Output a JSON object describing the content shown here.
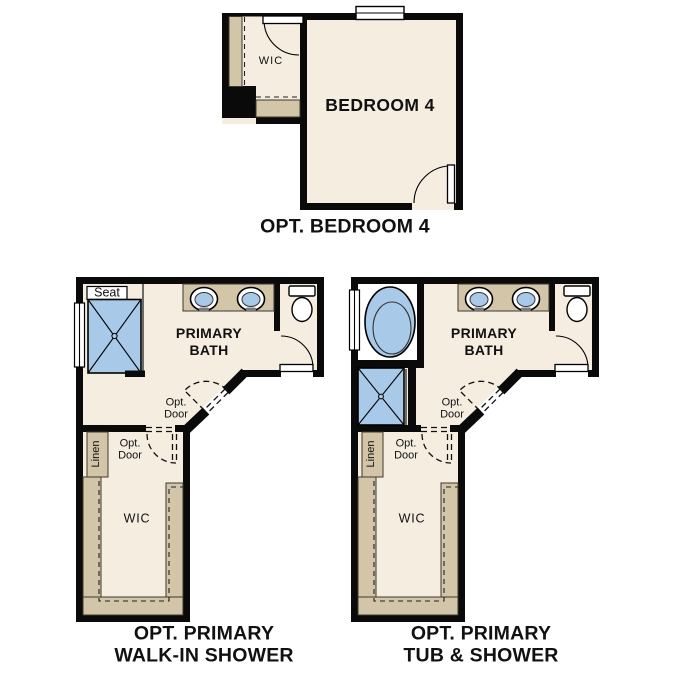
{
  "colors": {
    "wall": "#0a0a0a",
    "floor": "#f4ede0",
    "cabinet": "#d2c5a8",
    "fixture_blue": "#a9c9e9"
  },
  "plans": {
    "bedroom4": {
      "wic_label": "WIC",
      "room_label": "BEDROOM 4",
      "caption": "OPT. BEDROOM 4"
    },
    "walk_in_shower": {
      "seat_label": "Seat",
      "bath_label_line1": "PRIMARY",
      "bath_label_line2": "BATH",
      "opt_door_line1": "Opt.",
      "opt_door_line2": "Door",
      "linen_label": "Linen",
      "wic_label": "WIC",
      "caption_line1": "OPT. PRIMARY",
      "caption_line2": "WALK-IN SHOWER"
    },
    "tub_shower": {
      "bath_label_line1": "PRIMARY",
      "bath_label_line2": "BATH",
      "opt_door_line1": "Opt.",
      "opt_door_line2": "Door",
      "linen_label": "Linen",
      "wic_label": "WIC",
      "caption_line1": "OPT. PRIMARY",
      "caption_line2": "TUB & SHOWER"
    }
  }
}
